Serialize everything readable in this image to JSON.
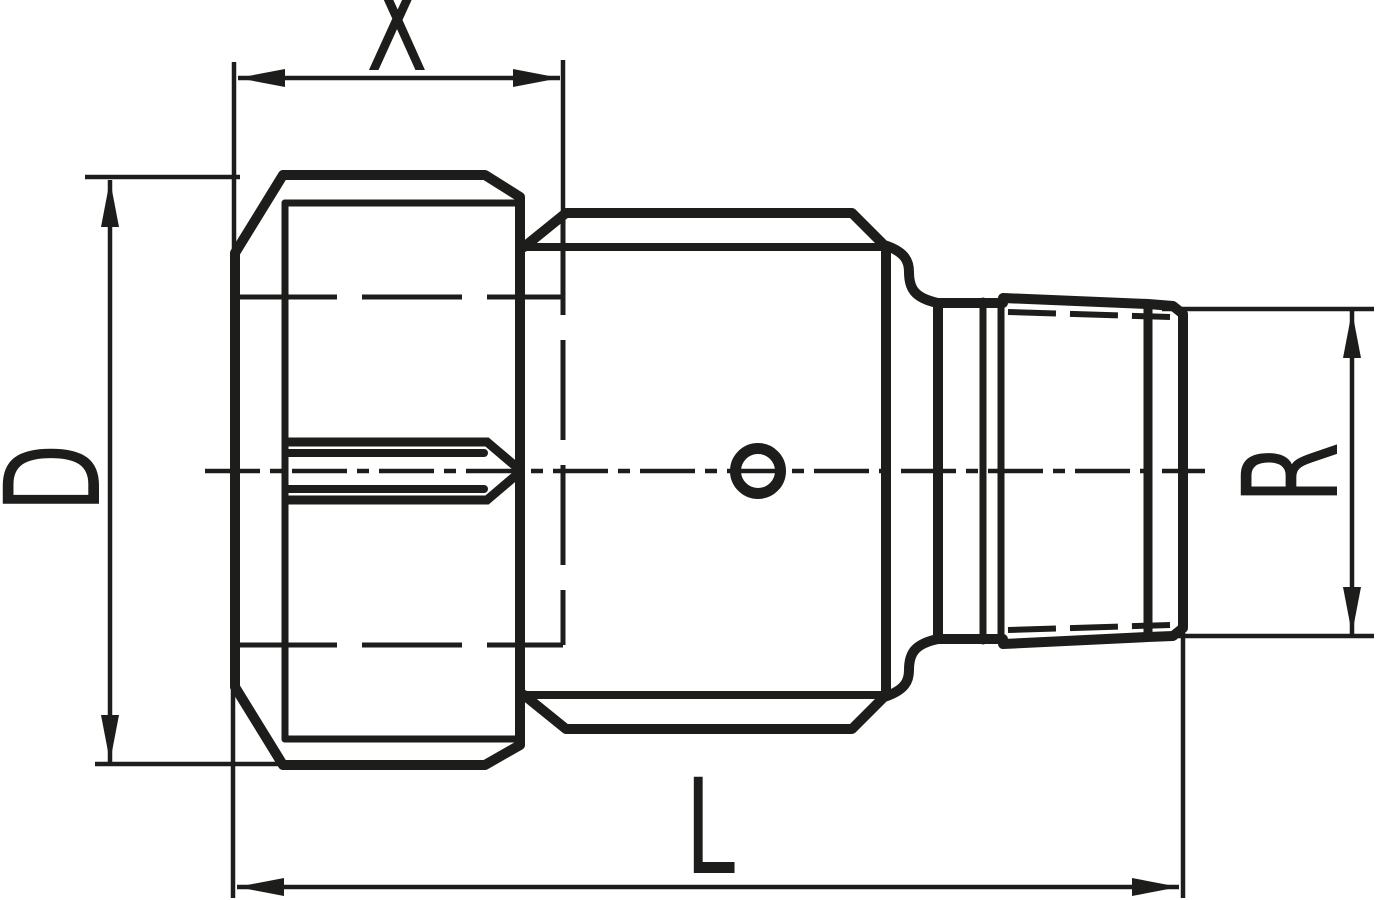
{
  "drawing": {
    "type": "technical-dimension-drawing",
    "ink_color": "#1d1d1b",
    "background_color": "#ffffff",
    "dimensions": {
      "x": {
        "label": "X"
      },
      "d": {
        "label": "D"
      },
      "l": {
        "label": "L"
      },
      "r": {
        "label": "R"
      }
    }
  }
}
